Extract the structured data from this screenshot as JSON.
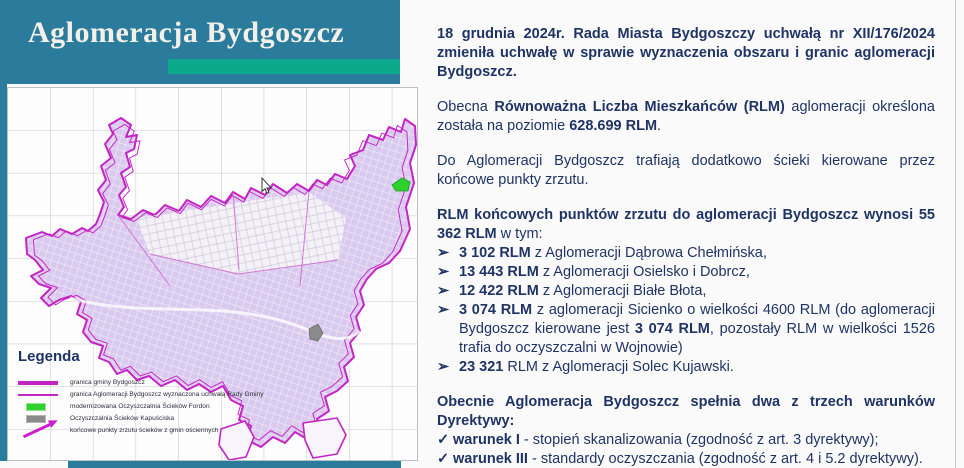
{
  "header": {
    "title": "Aglomeracja Bydgoszcz"
  },
  "colors": {
    "header_teal": "#2b7b9d",
    "accent_green": "#0ca88b",
    "text_navy": "#1f3464",
    "boundary_magenta": "#c424c4",
    "urban_fill": "#d9c9ee",
    "fordon_marker_green": "#2ed12e",
    "kapusciska_marker_gray": "#8a8a8a"
  },
  "map": {
    "cursor": "arrow-pointer",
    "markers": [
      {
        "name": "oczyszczalnia-fordon",
        "color": "#2ed12e"
      },
      {
        "name": "oczyszczalnia-kapusciska",
        "color": "#8a8a8a"
      }
    ],
    "legend": {
      "title": "Legenda",
      "items": [
        {
          "swatch": "sw-line-thick",
          "icon": "thick-magenta-line",
          "label": "granica gminy Bydgoszcz"
        },
        {
          "swatch": "sw-line-thin",
          "icon": "thin-magenta-line",
          "label": "granica Aglomeracji Bydgoszcz wyznaczona uchwałą Rady Gminy"
        },
        {
          "swatch": "sw-rect-green",
          "icon": "green-rect",
          "label": "modernizowana Oczyszczalnia Ścieków Fordon"
        },
        {
          "swatch": "sw-rect-gray",
          "icon": "gray-rect",
          "label": "Oczyszczalnia Ścieków Kapuściska"
        },
        {
          "swatch": "sw-arrow",
          "icon": "magenta-arrow",
          "label": "końcowe punkty zrzutu ścieków z gmin ościennych"
        }
      ]
    }
  },
  "content": {
    "blocks": [
      {
        "type": "p",
        "gap": false,
        "segments": [
          {
            "t": "18 grudnia 2024r. Rada Miasta Bydgoszczy uchwałą nr XII/176/2024 zmieniła uchwałę w sprawie wyznaczenia obszaru i granic aglomeracji Bydgoszcz.",
            "b": true
          }
        ]
      },
      {
        "type": "p",
        "gap": true,
        "segments": [
          {
            "t": "Obecna ",
            "b": false
          },
          {
            "t": "Równoważna Liczba Mieszkańców (RLM)",
            "b": true
          },
          {
            "t": " aglomeracji określona została na poziomie ",
            "b": false
          },
          {
            "t": "628.699 RLM",
            "b": true
          },
          {
            "t": ".",
            "b": false
          }
        ]
      },
      {
        "type": "p",
        "gap": true,
        "segments": [
          {
            "t": "Do Aglomeracji Bydgoszcz trafiają dodatkowo ścieki kierowane przez końcowe punkty zrzutu.",
            "b": false
          }
        ]
      },
      {
        "type": "p",
        "gap": true,
        "segments": [
          {
            "t": "RLM końcowych punktów zrzutu do aglomeracji Bydgoszcz wynosi 55 362 RLM",
            "b": true
          },
          {
            "t": " w tym:",
            "b": false
          }
        ]
      },
      {
        "type": "bullet",
        "marker": "➢",
        "gap": false,
        "segments": [
          {
            "t": "3 102 RLM",
            "b": true
          },
          {
            "t": " z Aglomeracji Dąbrowa Chełmińska,",
            "b": false
          }
        ]
      },
      {
        "type": "bullet",
        "marker": "➢",
        "gap": false,
        "segments": [
          {
            "t": "13 443 RLM",
            "b": true
          },
          {
            "t": " z Aglomeracji Osielsko i Dobrcz,",
            "b": false
          }
        ]
      },
      {
        "type": "bullet",
        "marker": "➢",
        "gap": false,
        "segments": [
          {
            "t": "12 422 RLM",
            "b": true
          },
          {
            "t": " z Aglomeracji Białe Błota,",
            "b": false
          }
        ]
      },
      {
        "type": "bullet",
        "marker": "➢",
        "gap": false,
        "segments": [
          {
            "t": "3 074 RLM",
            "b": true
          },
          {
            "t": " z aglomeracji Sicienko o wielkości 4600 RLM (do aglomeracji Bydgoszcz kierowane jest ",
            "b": false
          },
          {
            "t": "3 074 RLM",
            "b": true
          },
          {
            "t": ", pozostały RLM w wielkości 1526 trafia do oczyszczalni w Wojnowie)",
            "b": false
          }
        ]
      },
      {
        "type": "bullet",
        "marker": "➢",
        "gap": false,
        "segments": [
          {
            "t": "23 321",
            "b": true
          },
          {
            "t": " RLM z Aglomeracji Solec Kujawski.",
            "b": false
          }
        ]
      },
      {
        "type": "p",
        "gap": true,
        "segments": [
          {
            "t": "Obecnie Aglomeracja Bydgoszcz spełnia dwa z trzech warunków Dyrektywy:",
            "b": true
          }
        ]
      },
      {
        "type": "check",
        "marker": "✓",
        "gap": false,
        "segments": [
          {
            "t": "warunek I",
            "b": true
          },
          {
            "t": " - stopień skanalizowania (zgodność z art. 3 dyrektywy);",
            "b": false
          }
        ]
      },
      {
        "type": "check",
        "marker": "✓",
        "gap": false,
        "segments": [
          {
            "t": "warunek III",
            "b": true
          },
          {
            "t": "  - standardy oczyszczania (zgodność z art. 4 i 5.2 dyrektywy).",
            "b": false
          }
        ]
      },
      {
        "type": "last",
        "marker": "➢",
        "gap": false,
        "segments": [
          {
            "t": "niespełniony ",
            "b": false
          },
          {
            "t": "warunek II - wydajność oczyszczalni",
            "b": true
          }
        ]
      }
    ]
  }
}
